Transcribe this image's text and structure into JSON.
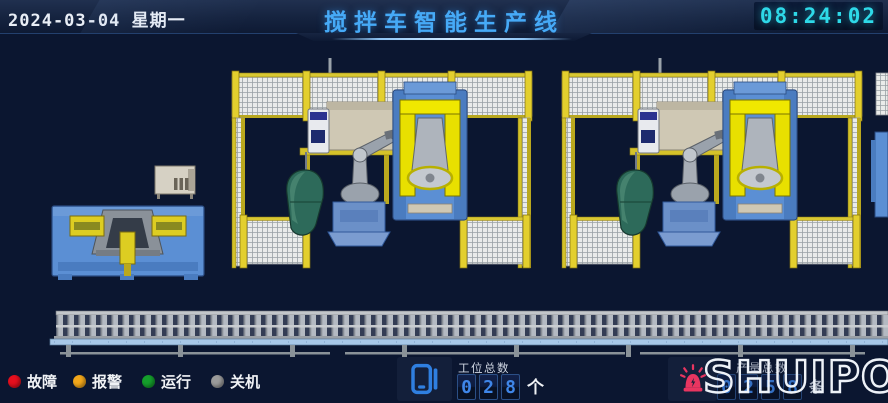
{
  "header": {
    "date": "2024-03-04 星期一",
    "title": "搅拌车智能生产线",
    "time": "08:24:02"
  },
  "legend": {
    "items": [
      {
        "label": "故障",
        "color": "#e60f1e"
      },
      {
        "label": "报警",
        "color": "#f2a71b"
      },
      {
        "label": "运行",
        "color": "#159f2c"
      },
      {
        "label": "关机",
        "color": "#9b9b9b"
      }
    ]
  },
  "station_counter": {
    "icon": "device-icon",
    "label": "工位总数",
    "digits": [
      "0",
      "2",
      "8"
    ],
    "unit": "个"
  },
  "output_counter": {
    "icon": "alarm-beacon-icon",
    "label": "产量总数",
    "digits": [
      "0",
      "2",
      "5",
      "8"
    ],
    "unit": "条"
  },
  "logo": {
    "text": "SHUIPO"
  },
  "colors": {
    "background": "#0b1630",
    "title": "#46aaf7",
    "clock": "#2ed9e8",
    "digit": "#3f86e8",
    "fault": "#e60f1e",
    "alarm": "#f2a71b",
    "run": "#159f2c",
    "off": "#9b9b9b",
    "beacon": "#e83560",
    "icon_blue": "#2f7fe0",
    "fence_yellow": "#d9c832",
    "machine_blue": "#5b8fd4",
    "robot_yellow": "#e8e000",
    "drum_green": "#2d6a5a"
  }
}
